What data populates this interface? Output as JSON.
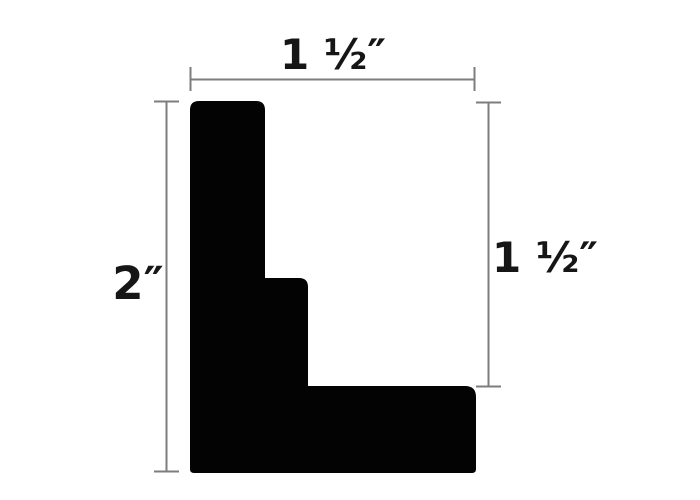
{
  "diagram": {
    "labels": {
      "top_width": "1 ½″",
      "overall_height": "2″",
      "right_height": "1 ½″"
    },
    "colors": {
      "shape": "#030303",
      "dimension_line": "#7d7d80",
      "text": "#161616",
      "background": "#ffffff"
    }
  }
}
